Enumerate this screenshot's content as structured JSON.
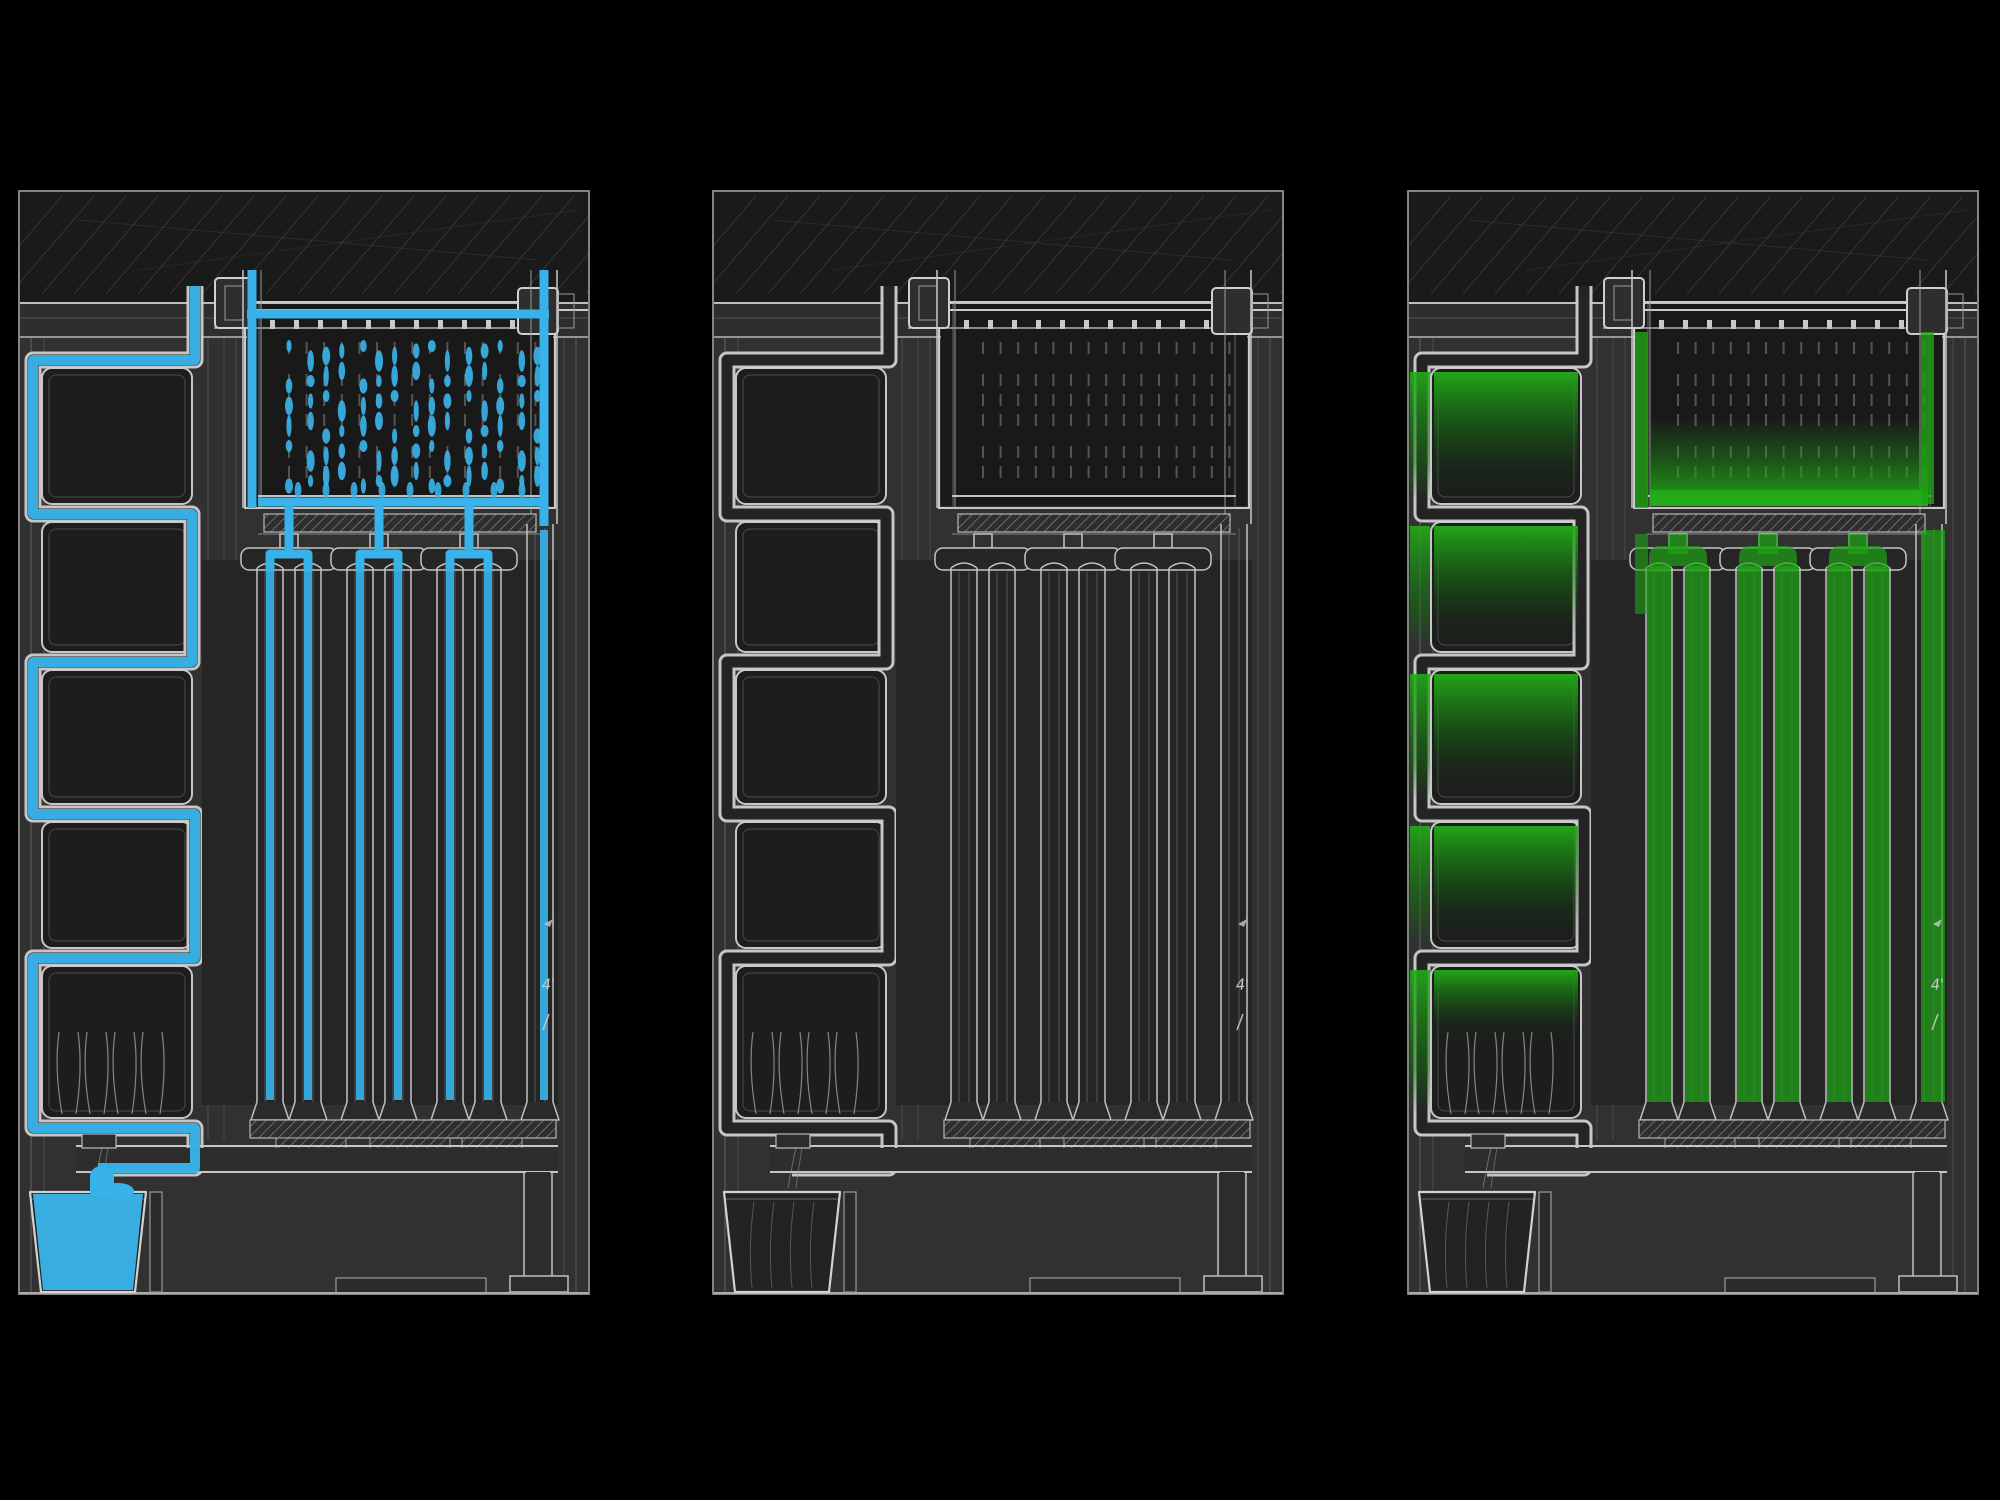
{
  "figure": {
    "type": "technical-section-triptych",
    "background": "#000000",
    "panels": [
      {
        "id": "water-flow",
        "label": "section with water path highlighted",
        "highlight": "water",
        "highlight_color": "#38B2E8",
        "annotation": "4'"
      },
      {
        "id": "base-drawing",
        "label": "plain section drawing",
        "highlight": "none",
        "highlight_color": "",
        "annotation": "4'"
      },
      {
        "id": "algae-growth",
        "label": "section with algae highlighted",
        "highlight": "algae",
        "highlight_color": "#1FA315",
        "annotation": "4'"
      }
    ],
    "colors": {
      "line_bright": "#cdcdcd",
      "line_mid": "#b5b5b5",
      "line_dim": "#8f8f8f",
      "panel_bg": "#343434",
      "panel_dark": "#1e1e1e",
      "band_dark": "#1a1a1a",
      "cavity": "#262626",
      "water": "#38B2E8",
      "algae": "#1FA315",
      "algae_bright": "#23AD18"
    }
  }
}
